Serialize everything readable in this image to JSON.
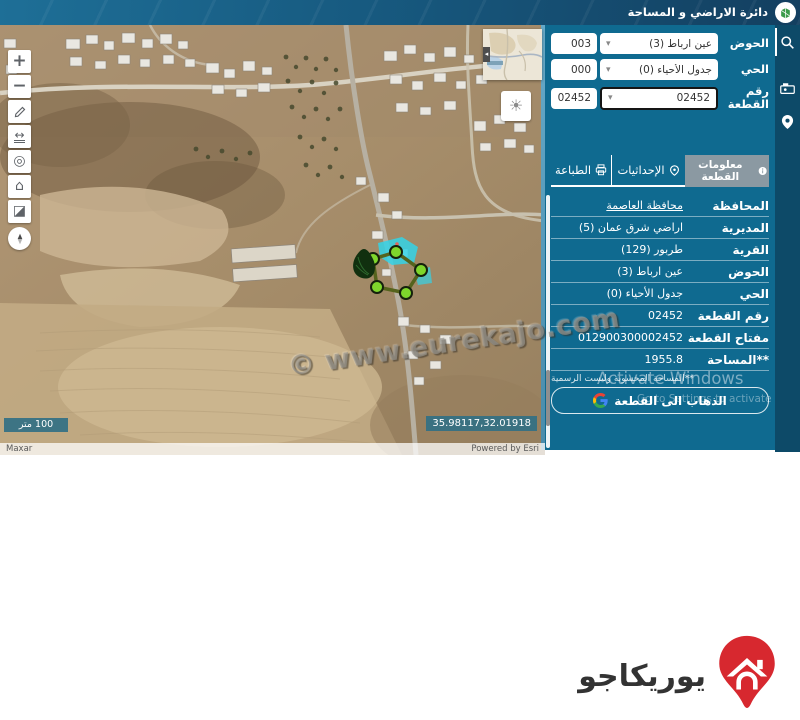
{
  "header": {
    "title": "دائرة الاراضي و المساحة"
  },
  "search_panel": {
    "rows": [
      {
        "label": "الحوض",
        "value": "عين ارباط (3)",
        "code": "003"
      },
      {
        "label": "الحي",
        "value": "جدول الأحياء (0)",
        "code": "000"
      },
      {
        "label": "رقم القطعة",
        "value": "02452",
        "code": "02452"
      }
    ]
  },
  "tabs": [
    {
      "label": "معلومات القطعة"
    },
    {
      "label": "الإحداثيات"
    },
    {
      "label": "الطباعة"
    }
  ],
  "info": {
    "rows": [
      {
        "label": "المحافظة",
        "value": "محافظة العاصمة"
      },
      {
        "label": "المديرية",
        "value": "اراضي شرق عمان (5)"
      },
      {
        "label": "القرية",
        "value": "طربور (129)"
      },
      {
        "label": "الحوض",
        "value": "عين ارباط (3)"
      },
      {
        "label": "الحي",
        "value": "جدول الأحياء (0)"
      },
      {
        "label": "رقم القطعة",
        "value": "02452"
      },
      {
        "label": "مفتاح القطعة",
        "value": "012900300002452"
      },
      {
        "label": "**المساحة",
        "value": "1955.8"
      }
    ],
    "note": "**المساحة المحسوبة وليست الرسمية",
    "go_button": "الذهاب الى القطعة"
  },
  "map": {
    "scale_label": "100 متر",
    "coordinates": "35.98117,32.01918",
    "attribution_left": "Maxar",
    "attribution_right": "Powered by Esri",
    "watermark": "© www.eurekajo.com"
  },
  "activate": {
    "line1": "Activate Windows",
    "line2": "Go to Settings to activate Windows."
  },
  "footer": {
    "brand": "يوريكاجو"
  },
  "icons": {
    "zoom_in": "+",
    "zoom_out": "−",
    "measure": "↔",
    "locate": "◎",
    "home": "⌂",
    "basemap": "◪",
    "sun": "☀",
    "caret": "▾",
    "collapse": "◂"
  }
}
